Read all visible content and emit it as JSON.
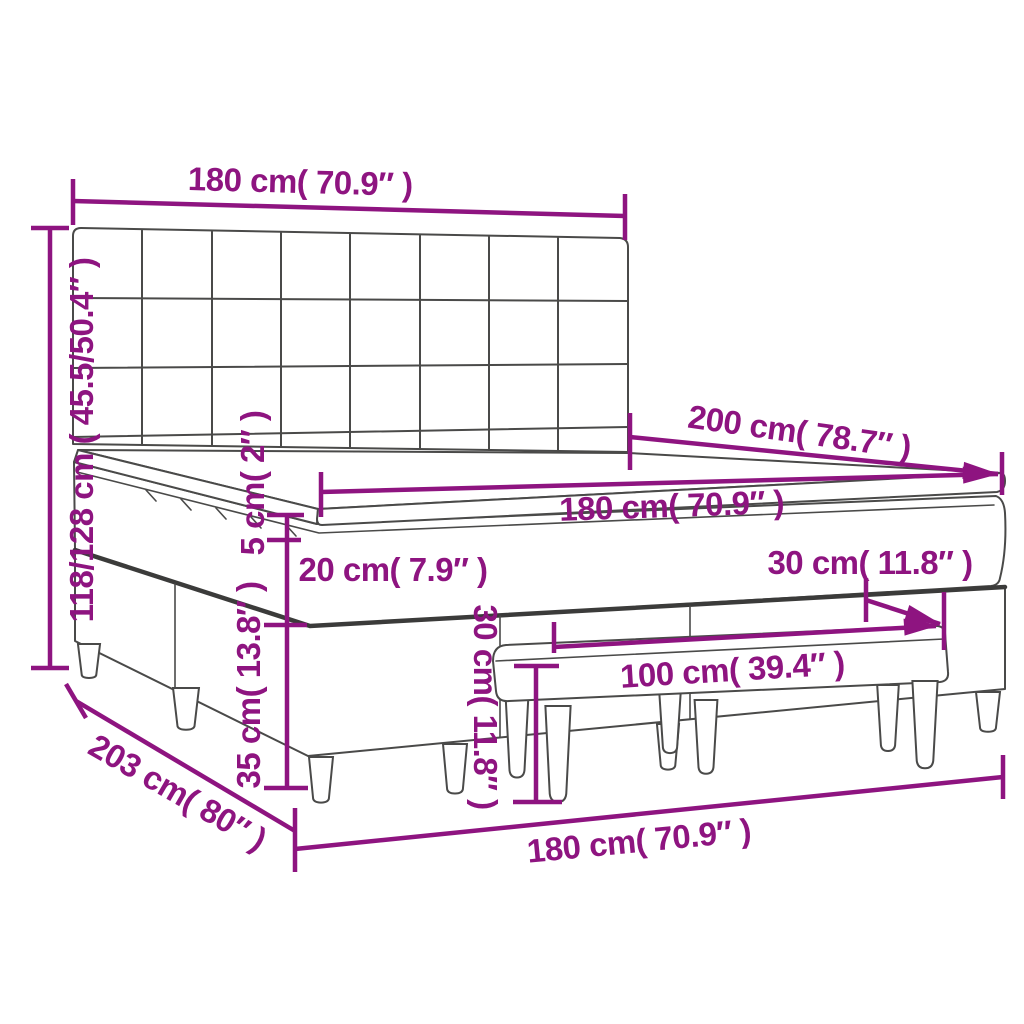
{
  "diagram": {
    "title": "Box spring bed with headboard, mattress topper and bench — dimension drawing",
    "colors": {
      "dimension_accent": "#8E1480",
      "line_art": "#4a4a49",
      "background": "#ffffff"
    },
    "labels": {
      "headboard_width": "180 cm( 70.9″ )",
      "overall_height": "118/128 cm ( 45.5/50.4″ )",
      "bed_length": "200 cm( 78.7″ )",
      "mattress_width": "180 cm( 70.9″ )",
      "topper_thickness": "5 cm( 2″ )",
      "mattress_thickness": "20 cm( 7.9″ )",
      "bench_depth": "30 cm( 11.8″ )",
      "base_height": "35 cm( 13.8″ )",
      "bench_height": "30 cm( 11.8″ )",
      "bench_length": "100 cm( 39.4″ )",
      "footprint_length": "203 cm( 80″ )",
      "bed_width_floor": "180 cm( 70.9″ )"
    }
  }
}
